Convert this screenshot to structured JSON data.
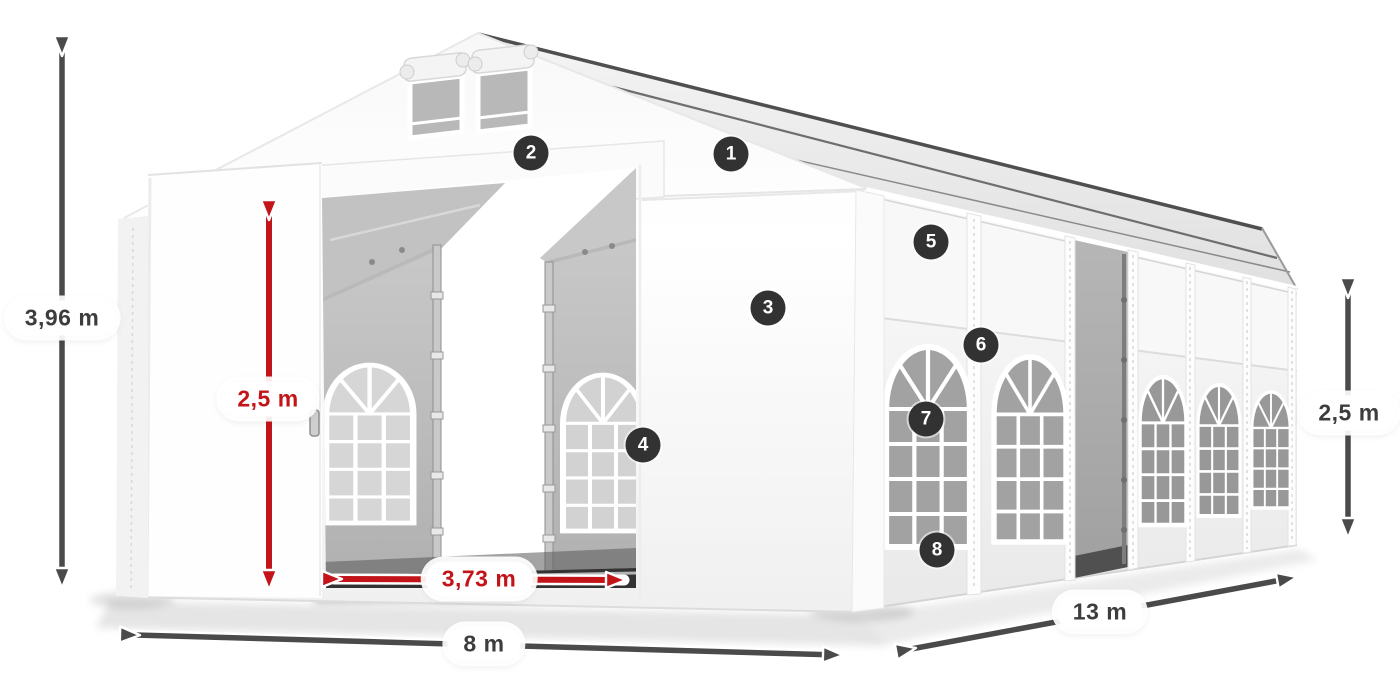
{
  "dimensions": {
    "total_height": {
      "label": "3,96 m",
      "style": "dark"
    },
    "door_height": {
      "label": "2,5 m",
      "style": "red"
    },
    "door_width": {
      "label": "3,73 m",
      "style": "red"
    },
    "front_width": {
      "label": "8 m",
      "style": "dark"
    },
    "side_length": {
      "label": "13 m",
      "style": "dark"
    },
    "side_height": {
      "label": "2,5 m",
      "style": "dark"
    }
  },
  "markers": [
    {
      "number": "1"
    },
    {
      "number": "2"
    },
    {
      "number": "3"
    },
    {
      "number": "4"
    },
    {
      "number": "5"
    },
    {
      "number": "6"
    },
    {
      "number": "7"
    },
    {
      "number": "8"
    }
  ],
  "colors": {
    "dimension_dark": "#4a4a4a",
    "dimension_red": "#c31419",
    "marker_background": "#323232",
    "marker_text": "#ffffff",
    "tent_white": "#ffffff",
    "interior_gray": "#bfbfbf"
  }
}
